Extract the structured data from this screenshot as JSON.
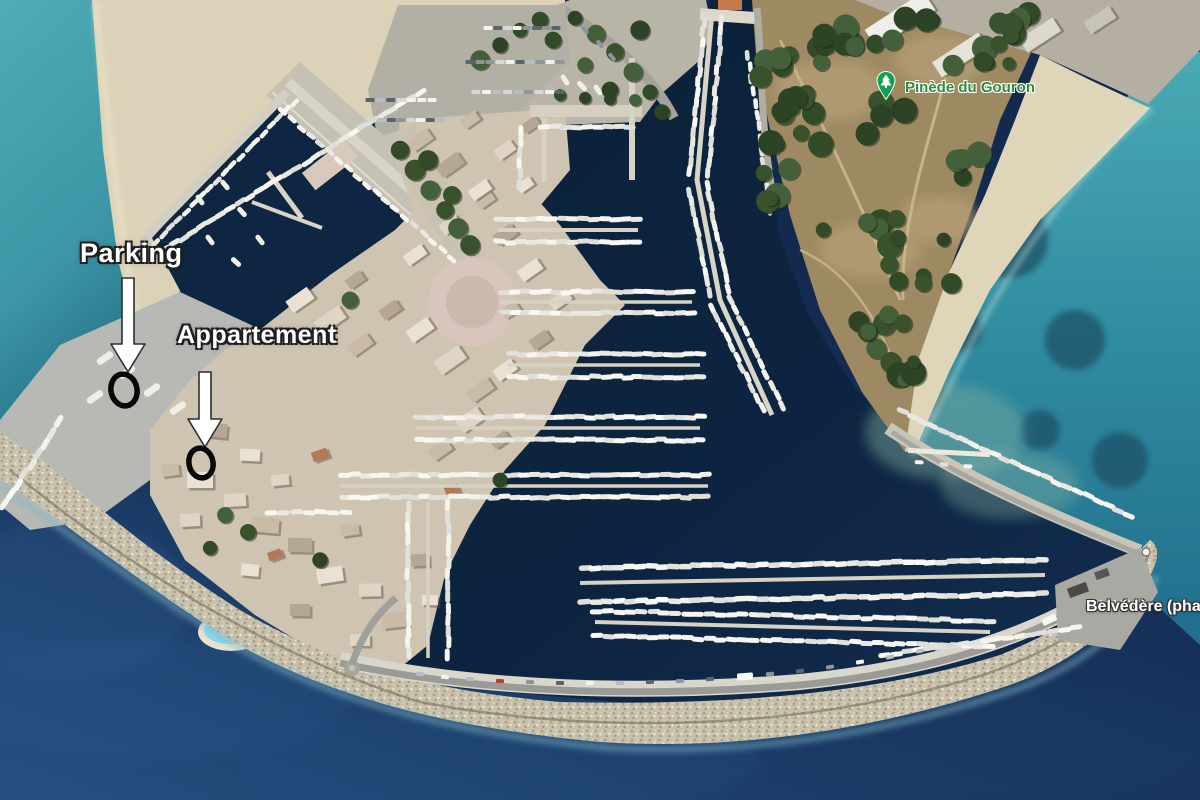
{
  "map": {
    "view": "satellite",
    "annotations": {
      "parking": {
        "label": "Parking",
        "text_x": 80,
        "text_y": 238,
        "arrow": {
          "x": 128,
          "tail_y": 278,
          "tip_y": 372
        },
        "circle": {
          "cx": 124,
          "cy": 390,
          "rx": 13,
          "ry": 16
        }
      },
      "apartment": {
        "label": "Appartement",
        "text_x": 177,
        "text_y": 321,
        "arrow": {
          "x": 205,
          "tail_y": 372,
          "tip_y": 447
        },
        "circle": {
          "cx": 201,
          "cy": 463,
          "rx": 12,
          "ry": 15
        }
      }
    },
    "pois": {
      "pinede": {
        "label": "Pinède du Gouron",
        "x": 905,
        "y": 79,
        "color": "#2e8b3f",
        "icon": "tree-pin",
        "icon_x": 886,
        "icon_y": 82,
        "icon_color": "#12a150"
      },
      "belvedere": {
        "label": "Belvédère (phare)",
        "x": 1086,
        "y": 598,
        "color": "#ffffff"
      }
    },
    "palette": {
      "sea_deep": "#16305a",
      "sea_turquoise": "#47a5b0",
      "sea_teal": "#2f8ba0",
      "marina_water": "#0d2440",
      "sand": "#d9cfb4",
      "rock_jetty": "#c7bfa9",
      "tree_green": "#31492a",
      "building": "#e2dacb",
      "quay": "#c2beb1",
      "boat_white": "#f2f1ea",
      "pool_blue": "#8fd9e9",
      "annotation_white": "#ffffff",
      "annotation_outline": "#1f1f1f",
      "circle_black": "#070707"
    }
  }
}
